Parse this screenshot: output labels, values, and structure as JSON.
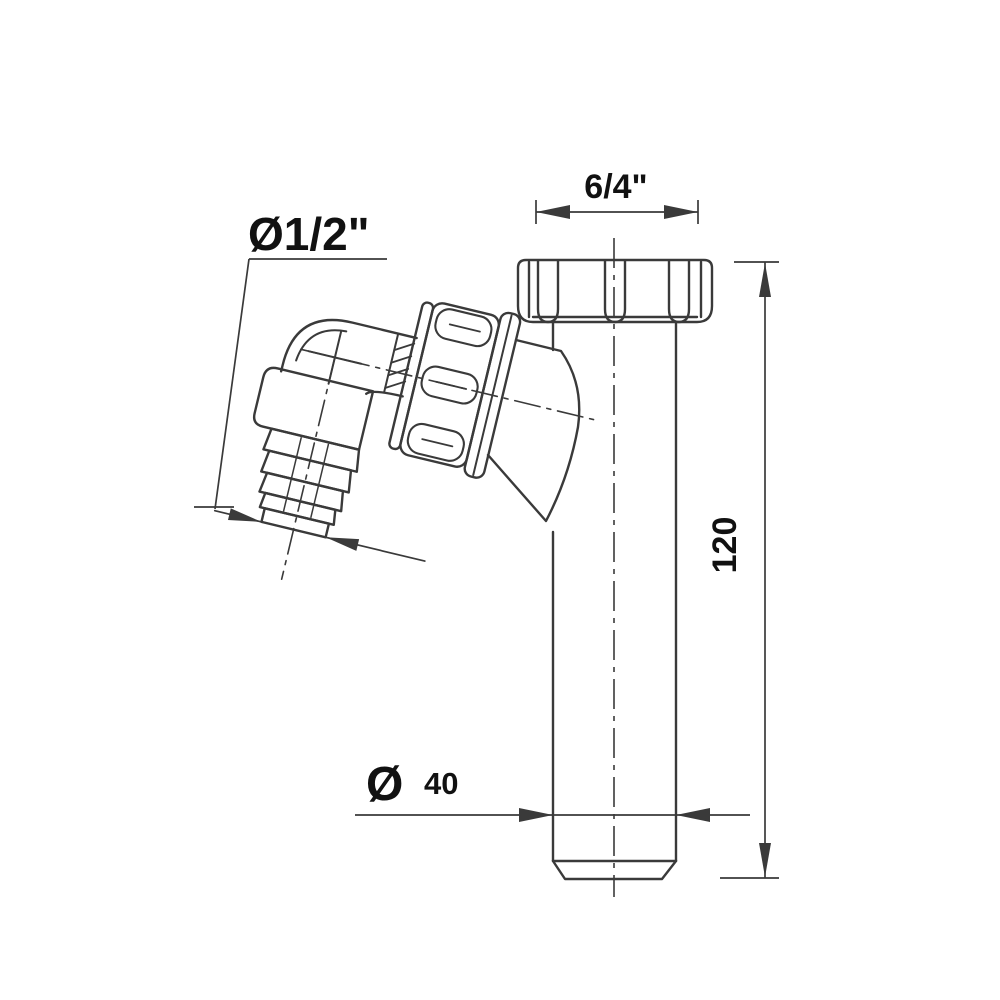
{
  "drawing": {
    "type": "technical-line-drawing",
    "subject": "drain-pipe-with-angled-hose-connector",
    "colors": {
      "background": "#ffffff",
      "line": "#3a3a3a",
      "text": "#111111"
    },
    "labels": {
      "hose_diameter": "Ø1/2\"",
      "nut_thread": "6/4\"",
      "tube_length": "120",
      "pipe_diameter_symbol": "Ø",
      "pipe_diameter_value": "40"
    }
  }
}
